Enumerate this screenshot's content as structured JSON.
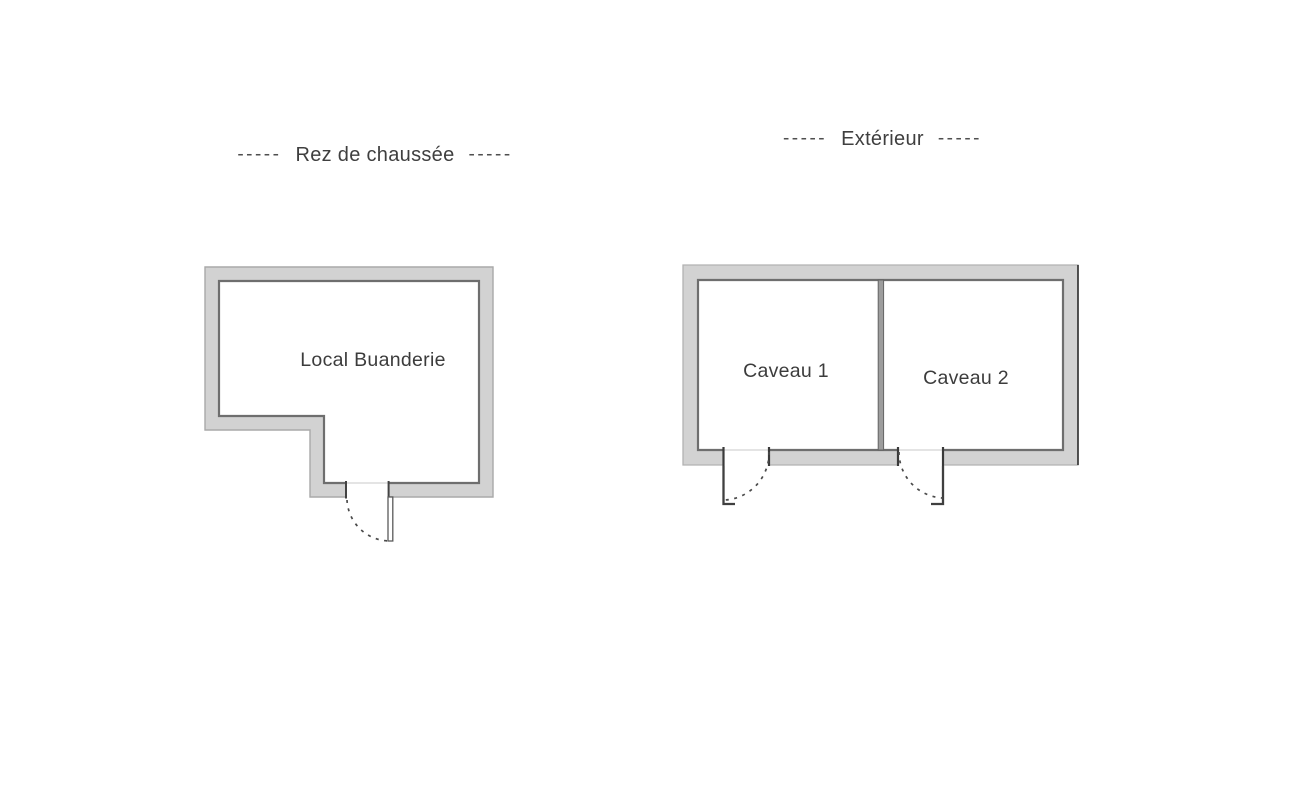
{
  "document": {
    "type": "floor-plan",
    "background": "#ffffff"
  },
  "plans": {
    "rez_de_chaussee": {
      "title": "Rez de chaussée",
      "title_dash_left": "-----",
      "title_dash_right": "-----",
      "rooms": [
        {
          "label": "Local Buanderie"
        }
      ],
      "doors": 1
    },
    "exterieur": {
      "title": "Extérieur",
      "title_dash_left": "-----",
      "title_dash_right": "-----",
      "rooms": [
        {
          "label": "Caveau 1"
        },
        {
          "label": "Caveau 2"
        }
      ],
      "doors": 2
    }
  },
  "colors": {
    "wall_fill": "#d2d2d2",
    "wall_outline_outer": "#a9a9a9",
    "wall_outline_inner": "#6e6e6e",
    "door_line": "#434343",
    "threshold_line": "#dcdcdc",
    "text": "#3c3c3c"
  }
}
